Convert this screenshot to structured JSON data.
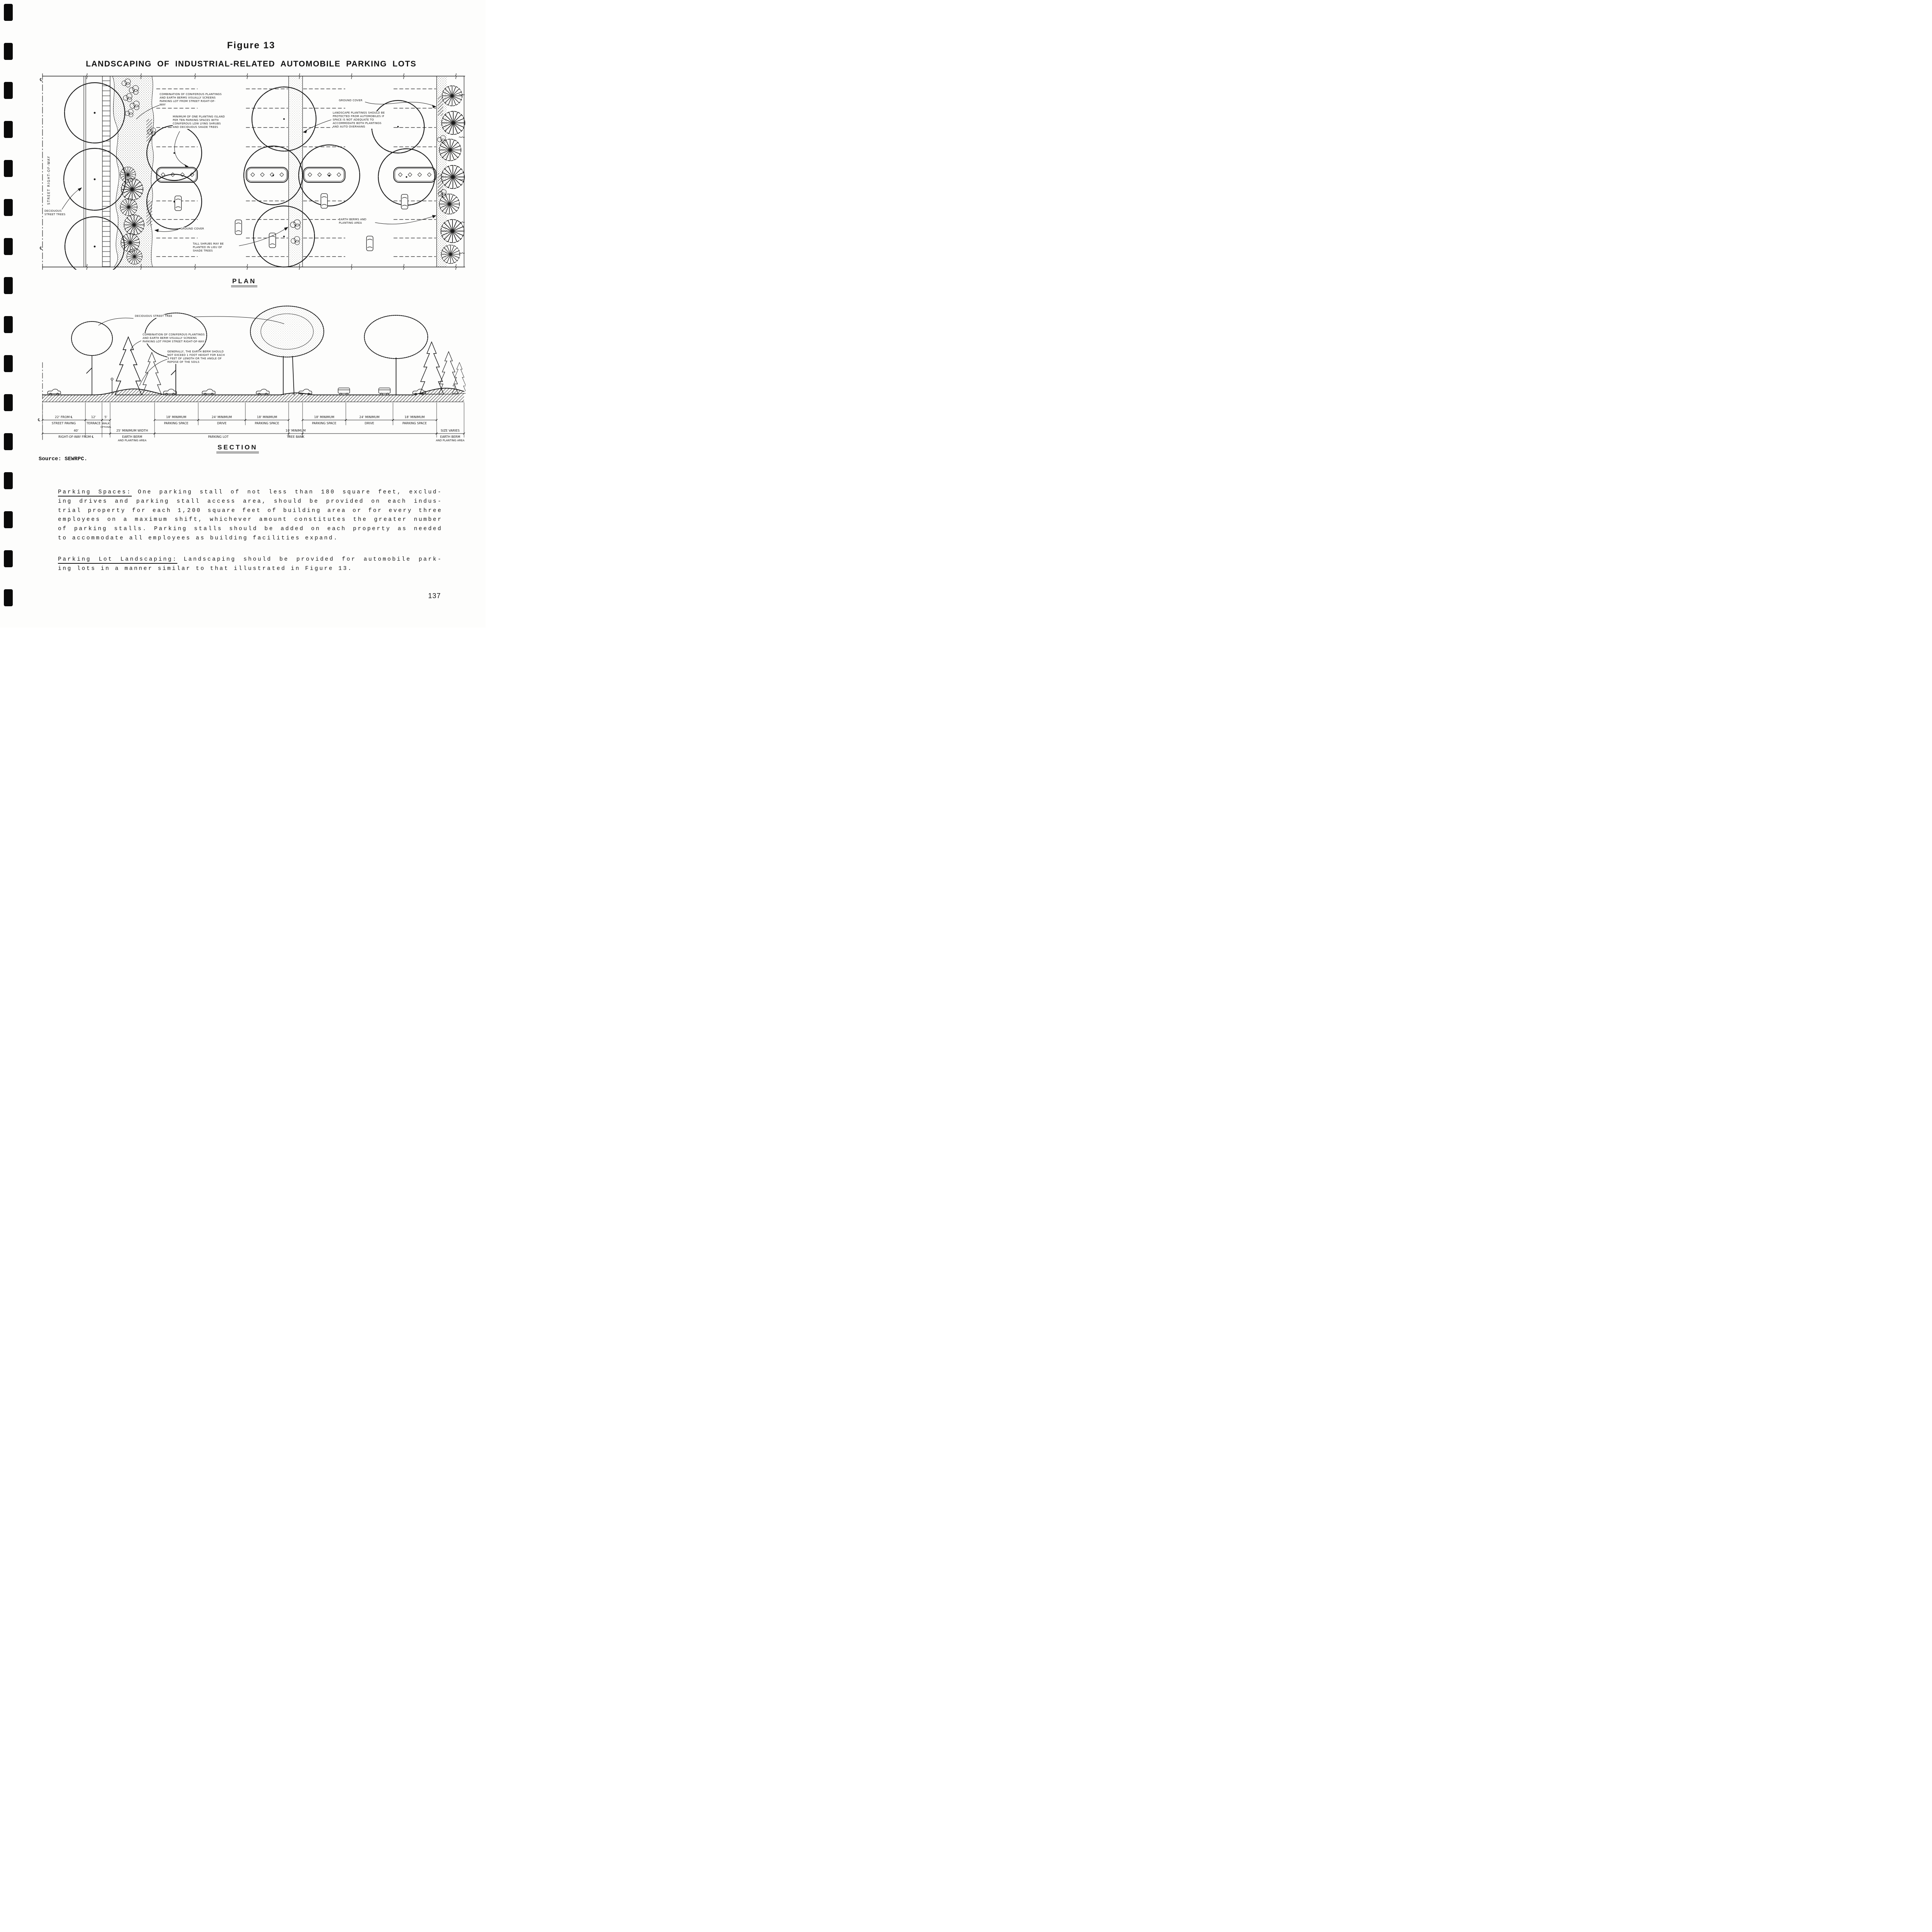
{
  "figure": {
    "label": "Figure 13",
    "title": "LANDSCAPING OF INDUSTRIAL-RELATED AUTOMOBILE PARKING LOTS",
    "plan_caption": "PLAN",
    "section_caption": "SECTION"
  },
  "plan": {
    "street_label": "STREET RIGHT-OF-WAY",
    "cl": "℄",
    "annotations": {
      "combo": {
        "lines": [
          "COMBINATION OF CONIFEROUS PLANTINGS",
          "AND EARTH BERMS VISUALLY SCREENS",
          "PARKING LOT FROM STREET RIGHT-OF-",
          "WAY"
        ]
      },
      "island_min": {
        "lines": [
          "MINIMUM OF ONE PLANTING ISLAND",
          "PER TEN PARKING SPACES WITH",
          "CONIFEROUS LOW LYING SHRUBS",
          "AND DECIDUOUS SHADE TREES"
        ]
      },
      "ground_cover_right": "GROUND COVER",
      "landscape": {
        "lines": [
          "LANDSCAPE PLANTINGS SHOULD BE",
          "PROTECTED FROM AUTOMOBILES IF",
          "SPACE IS NOT ADEQUATE TO",
          "ACCOMMODATE BOTH PLANTINGS",
          "AND AUTO OVERHANG"
        ]
      },
      "deciduous": {
        "lines": [
          "DECIDUOUS",
          "STREET TREES"
        ]
      },
      "ground_cover_left": "GROUND COVER",
      "tall_shrubs": {
        "lines": [
          "TALL SHRUBS MAY BE",
          "PLANTED IN LIEU OF",
          "SHADE TREES"
        ]
      },
      "earth_berms": {
        "lines": [
          "EARTH BERMS AND",
          "PLANTING AREA"
        ]
      }
    }
  },
  "section": {
    "cl": "℄",
    "annotations": {
      "deciduous_tree": "DECIDUOUS STREET TREE",
      "combo": {
        "lines": [
          "COMBINATION OF CONIFEROUS PLANTINGS",
          "AND EARTH BERM VISUALLY SCREENS",
          "PARKING LOT FROM STREET RIGHT-OF-WAY"
        ]
      },
      "berm_rule": {
        "lines": [
          "GENERALLY, THE EARTH BERM SHOULD",
          "NOT EXCEED 1 FOOT HEIGHT FOR EACH",
          "3 FEET OF LENGTH OR THE ANGLE OF",
          "REPOSE OF THE SOILS"
        ]
      }
    },
    "dims": {
      "r1": [
        {
          "top": "22' FROM ℄",
          "bottom": "STREET PAVING"
        },
        {
          "top": "12'",
          "bottom": "TERRACE"
        },
        {
          "top": "5'",
          "bottom": "WALK",
          "note": "OPTIONAL"
        },
        {
          "top": "18' MINIMUM",
          "bottom": "PARKING SPACE"
        },
        {
          "top": "24' MINIMUM",
          "bottom": "DRIVE"
        },
        {
          "top": "18' MINIMUM",
          "bottom": "PARKING SPACE"
        },
        {
          "top": "18' MINIMUM",
          "bottom": "PARKING SPACE"
        },
        {
          "top": "24' MINIMUM",
          "bottom": "DRIVE"
        },
        {
          "top": "18' MINIMUM",
          "bottom": "PARKING SPACE"
        }
      ],
      "r2": [
        {
          "top": "40'",
          "bottom": "RIGHT-OF-WAY FROM ℄"
        },
        {
          "top": "25' MINIMUM WIDTH",
          "bottom": "EARTH BERM",
          "bottom2": "AND PLANTING AREA"
        },
        {
          "top": "10' MINIMUM",
          "bottom": "TREE BANK"
        },
        {
          "bottom": "PARKING LOT"
        },
        {
          "top": "SIZE VARIES",
          "bottom": "EARTH BERM",
          "bottom2": "AND PLANTING AREA"
        }
      ]
    }
  },
  "source_line": "Source:  SEWRPC.",
  "body": {
    "p1": {
      "heading": "Parking Spaces:",
      "l1rest": "One parking stall of not less than 180 square feet, exclud-",
      "lines": [
        "ing drives and parking stall access area, should be provided on each indus-",
        "trial property for each 1,200 square feet of building area or for every three",
        "employees on a maximum shift, whichever amount constitutes the greater number",
        "of parking stalls.  Parking stalls should be added on each property as needed",
        "to accommodate all employees as building facilities expand."
      ]
    },
    "p2": {
      "heading": "Parking Lot Landscaping:",
      "l1rest": "Landscaping should be provided for automobile park-",
      "l2": "ing lots in a manner similar to that illustrated in Figure 13."
    }
  },
  "page_number": "137"
}
